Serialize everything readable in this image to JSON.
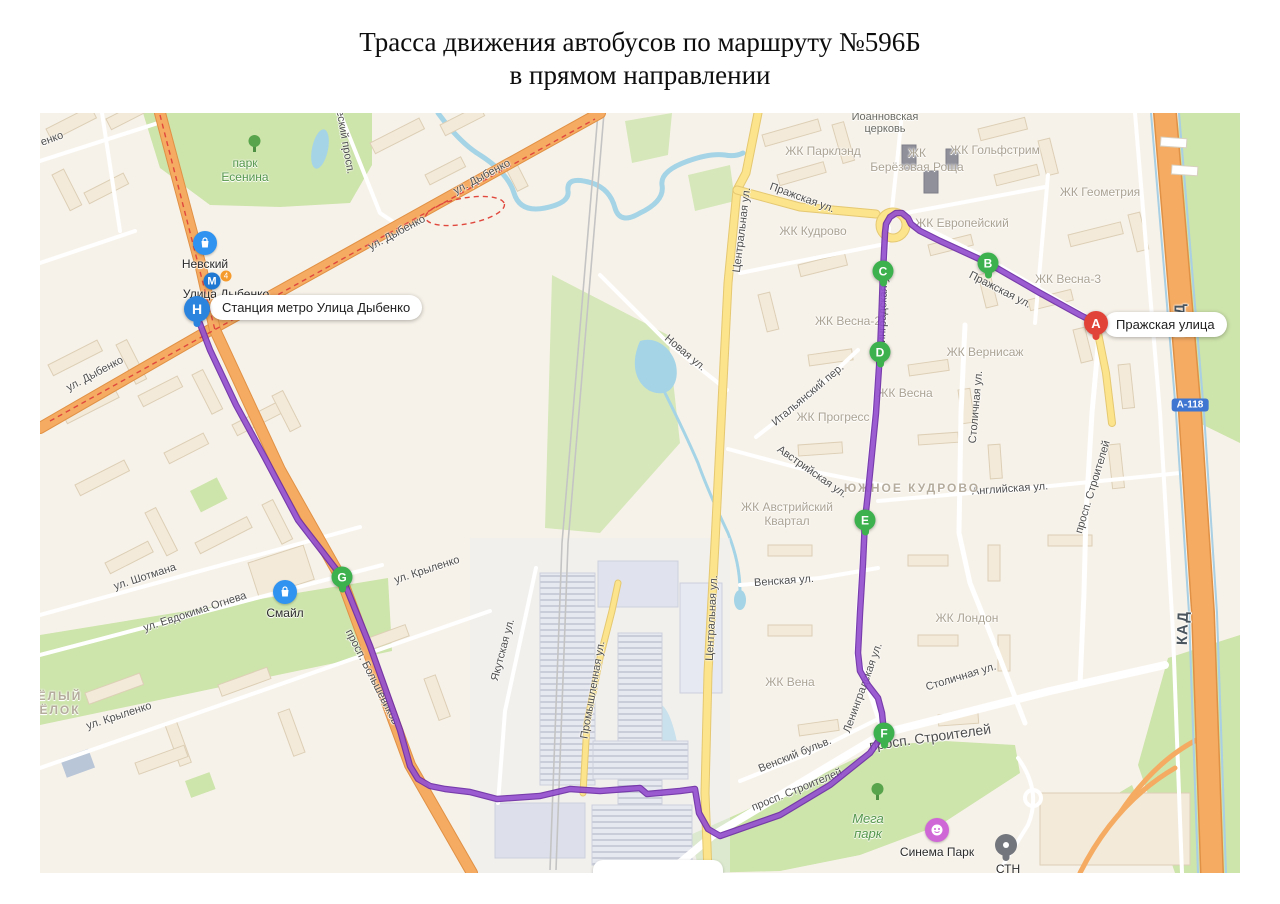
{
  "page": {
    "title_line1": "Трасса движения автобусов по маршруту №596Б",
    "title_line2": "в прямом направлении"
  },
  "map": {
    "route_color": "#8a42c7",
    "balloons": {
      "start": "Станция метро Улица Дыбенко",
      "end": "Пражская улица"
    },
    "markers": {
      "a": "A",
      "b": "B",
      "c": "C",
      "d": "D",
      "e": "E",
      "f": "F",
      "g": "G",
      "h": "H"
    },
    "pois": {
      "nevsky": "Невский",
      "metro_letter": "М",
      "metro_line": "4",
      "metro_name": "Улица Дыбенко",
      "smile": "Смайл",
      "cinema": "Синема Парк",
      "cut_poi": "СТН"
    },
    "roadsigns": {
      "a118": "А-118",
      "kad": "КАД"
    },
    "labels": {
      "park_esenina": "парк\nЕсенина",
      "ioann_church": "Иоанновская\nцерковь",
      "zk_parklend": "ЖК Парклэнд",
      "zk_berezovaya": "ЖК\nБерёзовая Роща",
      "zk_golfstrim": "ЖК Гольфстрим",
      "zk_geometria": "ЖК Геометрия",
      "zk_evropeisky": "ЖК Европейский",
      "zk_kudrovo": "ЖК Кудрово",
      "zk_vesna3": "ЖК Весна-3",
      "zk_vesna2": "ЖК Весна-2",
      "zk_vernisazh": "ЖК Вернисаж",
      "zk_vesna": "ЖК Весна",
      "zk_progress": "ЖК Прогресс",
      "zk_avstriysky": "ЖК Австрийский\nКвартал",
      "zk_london": "ЖК Лондон",
      "zk_vena": "ЖК Вена",
      "yuzhnoe_kudrovo": "ЮЖНОЕ КУДРОВО",
      "mega_park": "Мега\nпарк",
      "yoly": "ЁЛЫЙ\nЁЛОК",
      "ul_dybenko": "ул. Дыбенко",
      "esky_prosp": "еский просп.",
      "tsentralnaya": "Центральная ул.",
      "prazhskaya": "Пражская ул.",
      "novaya": "Новая ул.",
      "italiansky": "Итальянский пер.",
      "avstriyskaya": "Австрийская ул.",
      "stolichnaya": "Столичная ул.",
      "angliyskaya": "Английская ул.",
      "venskaya": "Венская ул.",
      "vensky_bulv": "Венский бульв.",
      "prosp_stroiteley": "просп. Строителей",
      "prosp_bolshevikov": "просп. Большевиков",
      "leningradskaya": "Ленинградская ул.",
      "promyshlennaya": "Промышленная ул.",
      "yakutskaya": "Якутская ул.",
      "shotmana": "ул. Шотмана",
      "ogneva": "ул. Евдокима Огнева",
      "krylenko": "ул. Крыленко",
      "enko": "енко"
    }
  }
}
